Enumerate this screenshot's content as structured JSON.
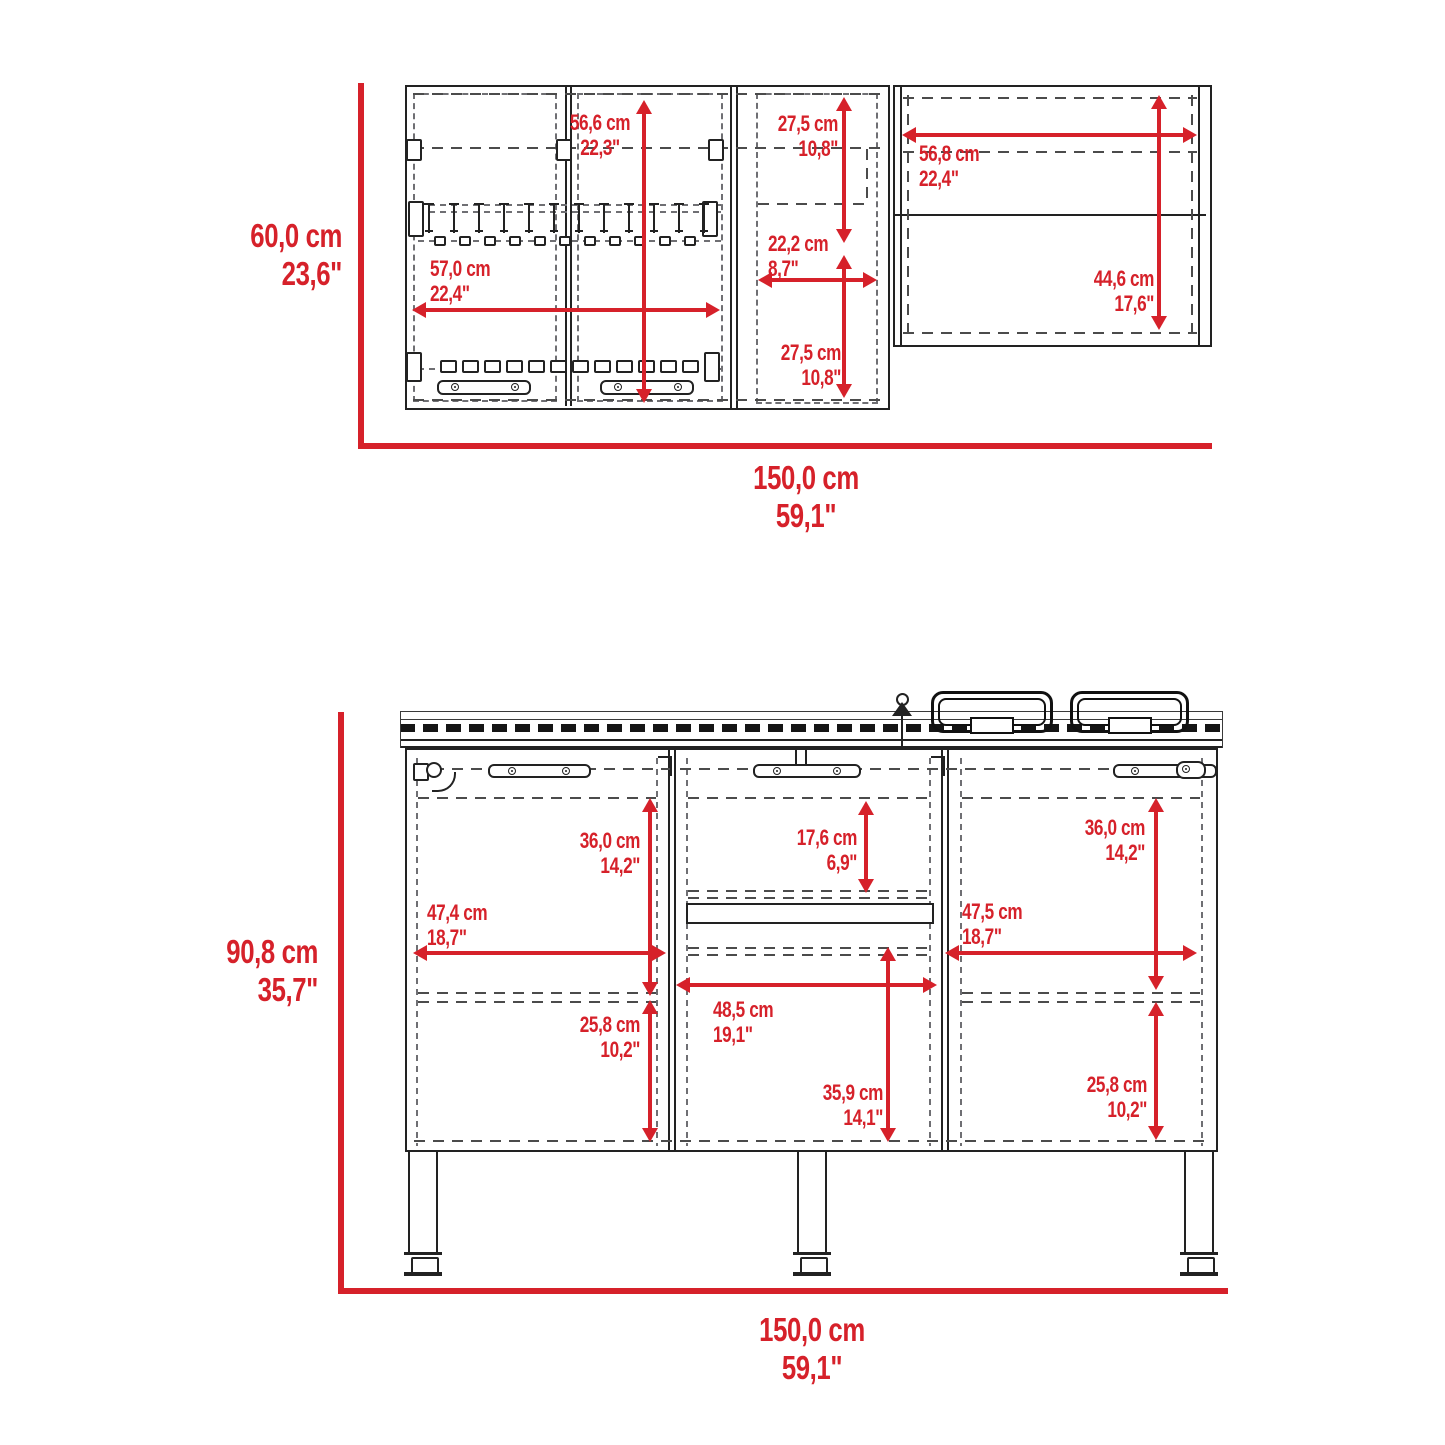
{
  "palette": {
    "accent_red": "#d6212a",
    "line_color": "#222222"
  },
  "upper_cabinet": {
    "overall_height": {
      "cm": "60,0 cm",
      "in": "23,6\""
    },
    "overall_width": {
      "cm": "150,0 cm",
      "in": "59,1\""
    },
    "door_interior_height": {
      "cm": "56,6 cm",
      "in": "22,3\""
    },
    "door_interior_width": {
      "cm": "57,0 cm",
      "in": "22,4\""
    },
    "middle_upper_height": {
      "cm": "27,5 cm",
      "in": "10,8\""
    },
    "middle_interior_width": {
      "cm": "22,2 cm",
      "in": "8,7\""
    },
    "middle_lower_height": {
      "cm": "27,5 cm",
      "in": "10,8\""
    },
    "open_shelf_width": {
      "cm": "56,8 cm",
      "in": "22,4\""
    },
    "open_shelf_height": {
      "cm": "44,6 cm",
      "in": "17,6\""
    }
  },
  "base_cabinet": {
    "overall_height": {
      "cm": "90,8 cm",
      "in": "35,7\""
    },
    "overall_width": {
      "cm": "150,0 cm",
      "in": "59,1\""
    },
    "left_upper_height": {
      "cm": "36,0 cm",
      "in": "14,2\""
    },
    "left_interior_width": {
      "cm": "47,4 cm",
      "in": "18,7\""
    },
    "left_lower_height": {
      "cm": "25,8 cm",
      "in": "10,2\""
    },
    "drawer_interior_height": {
      "cm": "17,6 cm",
      "in": "6,9\""
    },
    "middle_interior_width": {
      "cm": "48,5 cm",
      "in": "19,1\""
    },
    "middle_lower_height": {
      "cm": "35,9 cm",
      "in": "14,1\""
    },
    "right_upper_height": {
      "cm": "36,0 cm",
      "in": "14,2\""
    },
    "right_interior_width": {
      "cm": "47,5 cm",
      "in": "18,7\""
    },
    "right_lower_height": {
      "cm": "25,8 cm",
      "in": "10,2\""
    }
  }
}
